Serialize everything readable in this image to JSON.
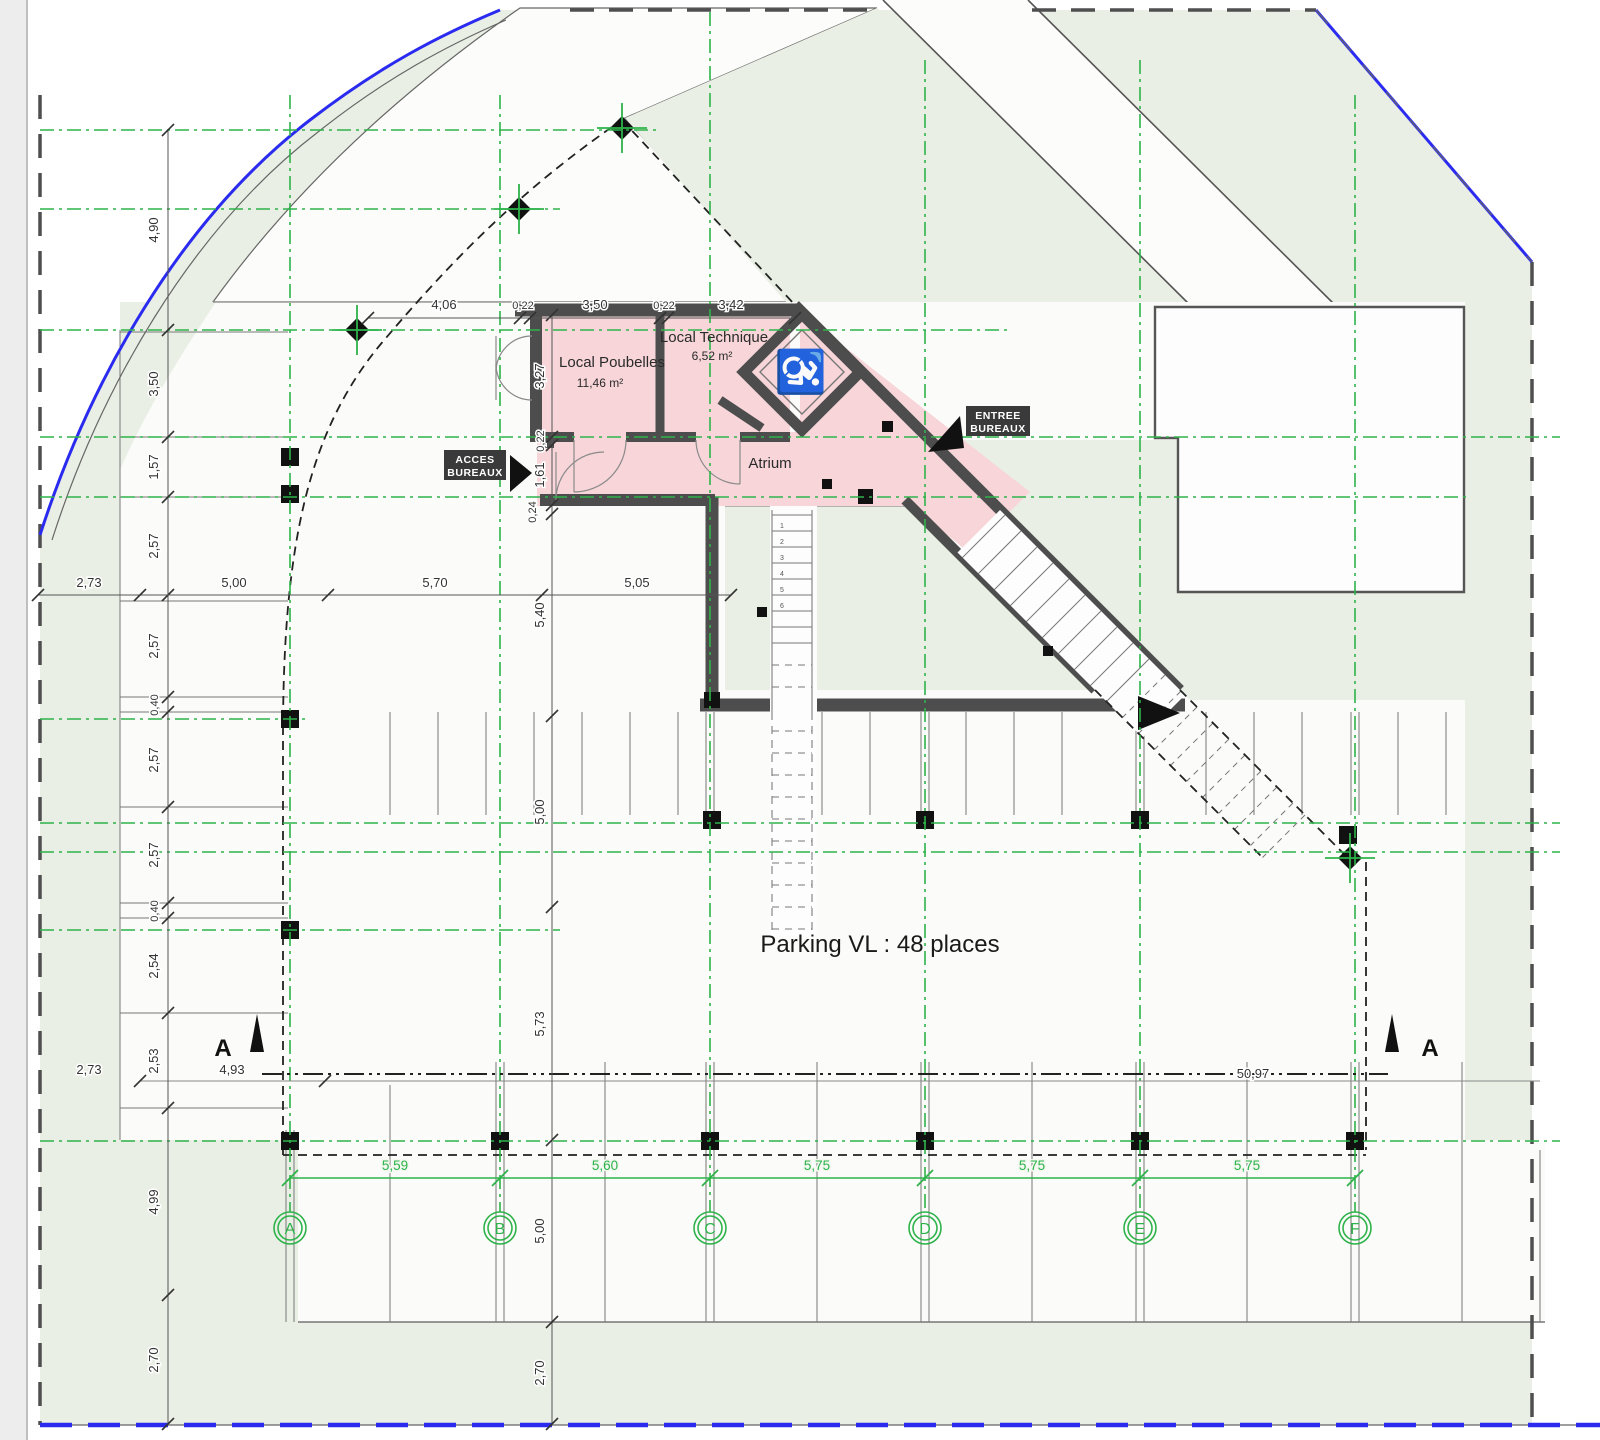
{
  "drawing": {
    "type": "architectural floor plan (parking level)",
    "parking_label": "Parking VL : 48 places",
    "rooms": {
      "poubelles": {
        "name": "Local Poubelles",
        "area": "11,46 m²"
      },
      "technique": {
        "name": "Local Technique",
        "area": "6,52 m²"
      },
      "atrium": {
        "name": "Atrium"
      }
    },
    "badges": {
      "acces": {
        "line1": "ACCES",
        "line2": "BUREAUX"
      },
      "entree": {
        "line1": "ENTREE",
        "line2": "BUREAUX"
      }
    },
    "section": {
      "letter_left": "A",
      "letter_right": "A",
      "overall": "50,97"
    },
    "grid": {
      "bubbles": [
        "A",
        "B",
        "C",
        "D",
        "E",
        "F"
      ],
      "spacings": [
        "5,59",
        "5,60",
        "5,75",
        "5,75",
        "5,75"
      ]
    },
    "dims": {
      "left_chain": [
        "4,90",
        "3,50",
        "1,57",
        "2,57",
        "2,57",
        "0,40",
        "2,57",
        "2,57",
        "0,40",
        "2,54",
        "2,53",
        "4,99",
        "2,70"
      ],
      "center_chain": [
        "3,27",
        "0,22",
        "1,61",
        "0,24",
        "5,40",
        "5,00",
        "5,73",
        "5,00",
        "2,70"
      ],
      "top_chain": [
        "4,06",
        "0,22",
        "3,50",
        "0,22",
        "3,42"
      ],
      "mid_horizontal": [
        "2,73",
        "5,00",
        "5,70",
        "5,05"
      ],
      "low_horizontal": [
        "2,73",
        "4,93"
      ]
    },
    "stairs": {
      "digits": [
        "1",
        "2",
        "3",
        "4",
        "5",
        "6"
      ]
    },
    "icons": {
      "wheelchair": "♿"
    },
    "colors": {
      "axis_green": "#2eb34a",
      "boundary_blue": "#2b2bf0",
      "wall_gray": "#4d4d4d",
      "room_pink": "#f7d5d8",
      "site_green": "#e9efe4"
    }
  }
}
